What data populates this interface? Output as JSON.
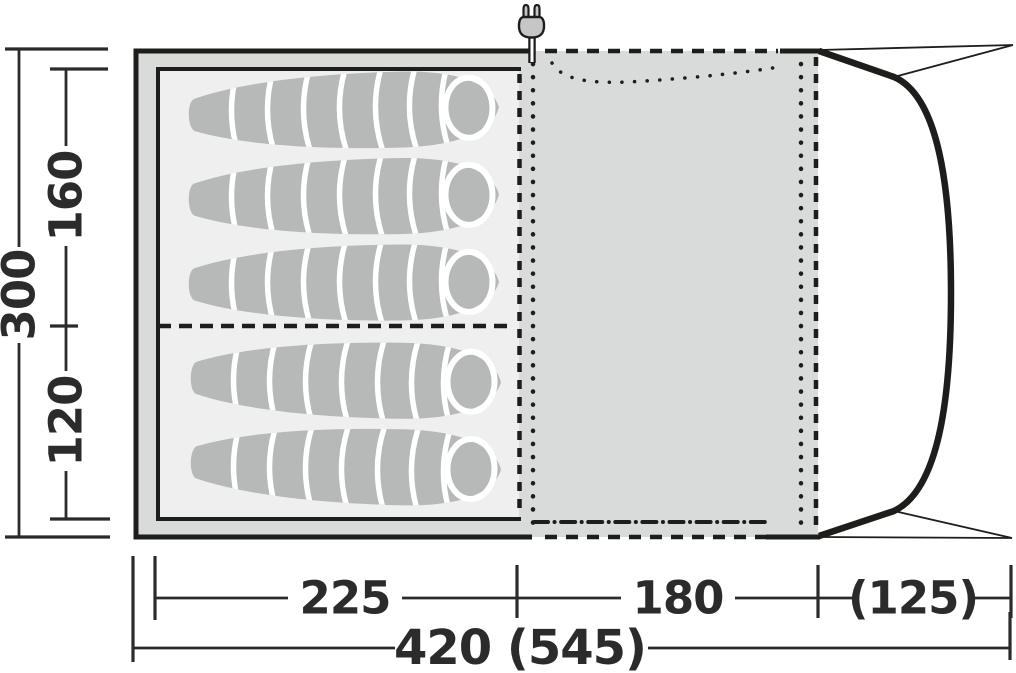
{
  "diagram": {
    "name": "Tent floor plan top view",
    "sleeping_bag_count": 5,
    "sections": [
      "sleeping cabin",
      "living area",
      "porch canopy"
    ]
  },
  "dimensions": {
    "depth_total": "300",
    "depth_rear": "160",
    "depth_front": "120",
    "width_sleeping": "225",
    "width_living": "180",
    "width_porch": "(125)",
    "width_total": "420 (545)"
  },
  "icons": {
    "power_plug": "power-plug-icon"
  },
  "colors": {
    "line": "#1d1d1b",
    "dimension_text": "#2b2b2b",
    "frame_gray": "#d9dada",
    "inner_cabin_fill": "#efefef",
    "sleeping_bag_fill": "#b7b8b8",
    "plug_body_fill": "#c6c6c6",
    "background": "#ffffff"
  }
}
